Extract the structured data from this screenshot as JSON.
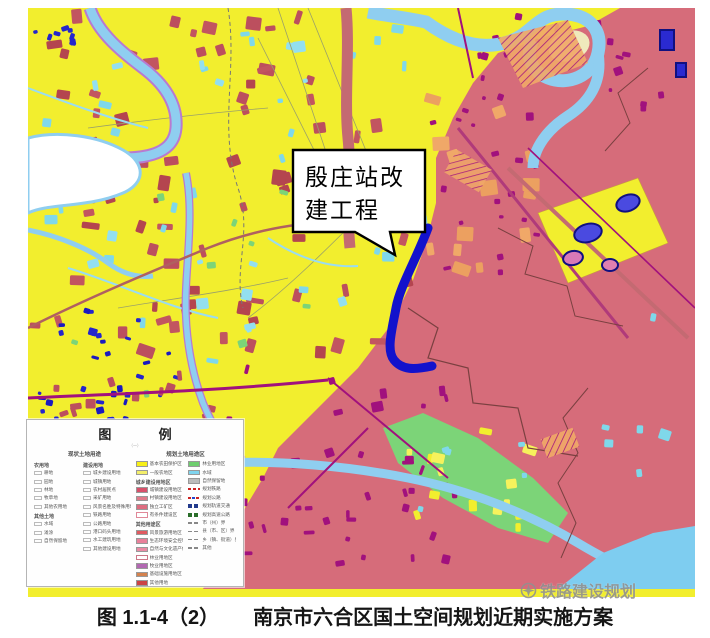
{
  "palette": {
    "farmland_yellow": "#f2ee2e",
    "urban_pink": "#d66c7a",
    "road_magenta": "#a1117d",
    "patch_maroon": "#bc4f5e",
    "river_blue": "#8fcef0",
    "patch_cyan": "#7fd8ea",
    "patch_navy": "#2323cb",
    "patch_orange": "#f0a868",
    "green_area": "#7cd478",
    "project_line_blue": "#1212cc"
  },
  "map": {
    "callout": {
      "line1": "殷庄站改",
      "line2": "建工程"
    }
  },
  "legend": {
    "title": "图  例",
    "subtitle": "（一）",
    "sections": {
      "current": "现状土地用途",
      "planned": "规划土地用途区"
    },
    "current_columns": [
      {
        "groups": [
          {
            "header": "农用地",
            "items": [
              "耕地",
              "园地",
              "林地",
              "牧草地",
              "其他农用地"
            ]
          },
          {
            "header": "其他土地",
            "items": [
              "水域",
              "滩涂",
              "自然保留地"
            ]
          }
        ]
      },
      {
        "groups": [
          {
            "header": "建设用地",
            "items": [
              "城乡建设用地",
              "城镇用地",
              "农村居民点",
              "采矿用地",
              "风景名胜及特殊用地",
              "铁路用地",
              "公路用地",
              "港口码头用地",
              "水工建筑用地",
              "其他建设用地"
            ]
          }
        ]
      }
    ],
    "planned_columns": [
      {
        "rows": [
          {
            "label": "基本农田保护区",
            "sw": "fill",
            "color": "#f7f018"
          },
          {
            "label": "一般农地区",
            "sw": "fill",
            "color": "#f3ee6a"
          },
          {
            "label": "城乡建设用地区",
            "sw": "header"
          },
          {
            "label": "城镇建设用地区",
            "sw": "fill",
            "color": "#d8506a"
          },
          {
            "label": "村镇建设用地区",
            "sw": "fill",
            "color": "#e07a8a"
          },
          {
            "label": "独立工矿区",
            "sw": "fill",
            "color": "#dd6d80"
          },
          {
            "label": "有条件建设区",
            "sw": "outline",
            "color": "#e08898"
          },
          {
            "label": "其他用途区",
            "sw": "header"
          },
          {
            "label": "风景旅游用地区",
            "sw": "fill",
            "color": "#e05a60"
          },
          {
            "label": "生态环境安全控制区",
            "sw": "fill",
            "color": "#e8809a"
          },
          {
            "label": "自然与文化遗产保护区",
            "sw": "fill",
            "color": "#ea8aa4"
          },
          {
            "label": "林业用地区",
            "sw": "outline",
            "color": "#cc7788"
          },
          {
            "label": "牧业用地区",
            "sw": "fill",
            "color": "#b268b2"
          },
          {
            "label": "基础设施用地区",
            "sw": "fill",
            "color": "#d4824e"
          },
          {
            "label": "其他用地",
            "sw": "fill",
            "color": "#cc4444"
          }
        ]
      },
      {
        "rows": [
          {
            "label": "林业用地区",
            "sw": "fill",
            "color": "#6fce6f"
          },
          {
            "label": "水域",
            "sw": "fill",
            "color": "#7fd4ee"
          },
          {
            "label": "自然保留地",
            "sw": "fill",
            "color": "#bbbbbb"
          },
          {
            "label": "规划铁路",
            "sw": "dash",
            "color": "#cc2222"
          },
          {
            "label": "规划公路",
            "sw": "dash2",
            "color": "#cc2222"
          },
          {
            "label": "规划轨道交通",
            "sw": "squares",
            "color": "#223a8c"
          },
          {
            "label": "规划高速公路",
            "sw": "squares",
            "color": "#2a6e2a"
          },
          {
            "label": "市（州）界",
            "sw": "gray-dash",
            "color": "#888888"
          },
          {
            "label": "县（市、区）界",
            "sw": "gray-dash",
            "color": "#888888"
          },
          {
            "label": "乡（镇、街道）界",
            "sw": "gray-dash",
            "color": "#888888"
          },
          {
            "label": "其他",
            "sw": "gray-dash",
            "color": "#888888"
          }
        ]
      }
    ]
  },
  "caption": {
    "figure_label": "图 1.1-4（2）",
    "title": "南京市六合区国土空间规划近期实施方案"
  },
  "watermark": {
    "text": "铁路建设规划"
  }
}
